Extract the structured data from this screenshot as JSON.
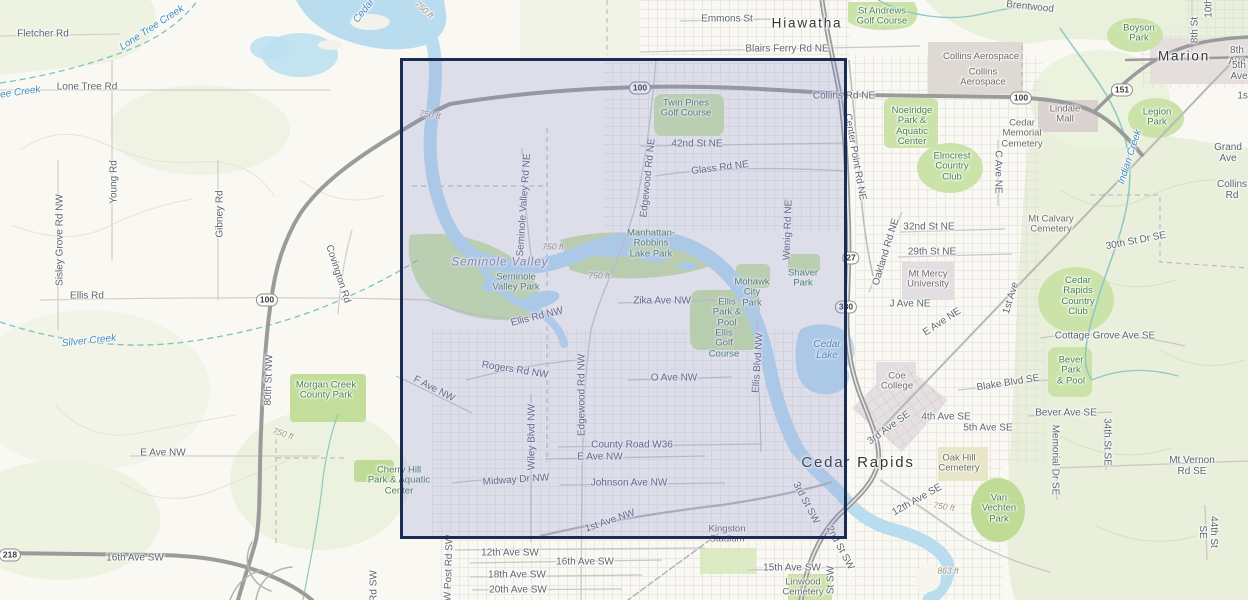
{
  "colors": {
    "selection_border": "#1a2c52",
    "selection_fill": "rgba(126,133,204,0.22)",
    "water": "#b9dcef",
    "water_label": "#3f8cbf",
    "park_fill": "#cbe3a9",
    "park_label": "#47824b",
    "road_label": "#5d666d",
    "poi_label": "#6f6b67",
    "city_label": "#333538",
    "contour_label": "#9c9178",
    "major_road": "#9b9b9b",
    "background": "#f9f8f3"
  },
  "selection": {
    "x": 400,
    "y": 58,
    "width": 447,
    "height": 481
  },
  "map": {
    "labels": [
      {
        "text": "Hiawatha",
        "x": 807,
        "y": 24,
        "type": "city"
      },
      {
        "text": "Marion",
        "x": 1184,
        "y": 57,
        "type": "city"
      },
      {
        "text": "Cedar Rapids",
        "x": 858,
        "y": 463,
        "type": "city",
        "size": 15
      },
      {
        "text": "Fletcher Rd",
        "x": 43,
        "y": 34,
        "type": "road"
      },
      {
        "text": "Lone Tree Rd",
        "x": 87,
        "y": 87,
        "type": "road"
      },
      {
        "text": "Young Rd",
        "x": 114,
        "y": 182,
        "type": "road",
        "rot": -90
      },
      {
        "text": "Sisley Grove Rd NW",
        "x": 60,
        "y": 240,
        "type": "road",
        "rot": -90
      },
      {
        "text": "Gibney Rd",
        "x": 220,
        "y": 214,
        "type": "road",
        "rot": -90
      },
      {
        "text": "Ellis Rd",
        "x": 87,
        "y": 296,
        "type": "road"
      },
      {
        "text": "Covington Rd",
        "x": 338,
        "y": 274,
        "type": "road",
        "rot": 72
      },
      {
        "text": "80th St NW",
        "x": 269,
        "y": 380,
        "type": "road",
        "rot": -88
      },
      {
        "text": "E Ave NW",
        "x": 163,
        "y": 453,
        "type": "road"
      },
      {
        "text": "16th Ave SW",
        "x": 135,
        "y": 558,
        "type": "road"
      },
      {
        "text": "Emmons St",
        "x": 727,
        "y": 19,
        "type": "road"
      },
      {
        "text": "Blairs Ferry Rd NE",
        "x": 787,
        "y": 49,
        "type": "road"
      },
      {
        "text": "Collins Rd NE",
        "x": 844,
        "y": 96,
        "type": "road"
      },
      {
        "text": "42nd St NE",
        "x": 697,
        "y": 144,
        "type": "road"
      },
      {
        "text": "Glass Rd NE",
        "x": 720,
        "y": 168,
        "type": "road",
        "rot": -7
      },
      {
        "text": "Seminole Valley Rd NE",
        "x": 524,
        "y": 205,
        "type": "road",
        "rot": -86
      },
      {
        "text": "Edgewood Rd NE",
        "x": 648,
        "y": 178,
        "type": "road",
        "rot": -84
      },
      {
        "text": "Wenig Rd NE",
        "x": 788,
        "y": 230,
        "type": "road",
        "rot": -88
      },
      {
        "text": "Center Point Rd NE",
        "x": 855,
        "y": 157,
        "type": "road",
        "rot": 80
      },
      {
        "text": "Oakland Rd NE",
        "x": 886,
        "y": 252,
        "type": "road",
        "rot": -73
      },
      {
        "text": "32nd St NE",
        "x": 929,
        "y": 227,
        "type": "road"
      },
      {
        "text": "29th St NE",
        "x": 932,
        "y": 252,
        "type": "road"
      },
      {
        "text": "C Ave NE",
        "x": 998,
        "y": 172,
        "type": "road",
        "rot": 90
      },
      {
        "text": "J Ave NE",
        "x": 910,
        "y": 304,
        "type": "road"
      },
      {
        "text": "E Ave NE",
        "x": 942,
        "y": 322,
        "type": "road",
        "rot": -33
      },
      {
        "text": "1st Ave",
        "x": 1011,
        "y": 298,
        "type": "road",
        "rot": -73
      },
      {
        "text": "Grand Ave",
        "x": 1228,
        "y": 153,
        "type": "road"
      },
      {
        "text": "Collins Rd",
        "x": 1232,
        "y": 190,
        "type": "road"
      },
      {
        "text": "8th Ave",
        "x": 1237,
        "y": 56,
        "type": "road"
      },
      {
        "text": "5th Ave",
        "x": 1239,
        "y": 71,
        "type": "road"
      },
      {
        "text": "1st",
        "x": 1244,
        "y": 96,
        "type": "road"
      },
      {
        "text": "8th St",
        "x": 1195,
        "y": 30,
        "type": "road",
        "rot": -90
      },
      {
        "text": "10th",
        "x": 1209,
        "y": 8,
        "type": "road",
        "rot": -90
      },
      {
        "text": "Brentwood",
        "x": 1030,
        "y": 7,
        "type": "road",
        "rot": 6
      },
      {
        "text": "30th St Dr SE",
        "x": 1136,
        "y": 241,
        "type": "road",
        "rot": -11
      },
      {
        "text": "Cottage Grove Ave SE",
        "x": 1105,
        "y": 336,
        "type": "road"
      },
      {
        "text": "Blake Blvd SE",
        "x": 1008,
        "y": 383,
        "type": "road",
        "rot": -9
      },
      {
        "text": "Bever Ave SE",
        "x": 1066,
        "y": 413,
        "type": "road"
      },
      {
        "text": "4th Ave SE",
        "x": 946,
        "y": 417,
        "type": "road"
      },
      {
        "text": "5th Ave SE",
        "x": 988,
        "y": 428,
        "type": "road"
      },
      {
        "text": "3rd Ave SE",
        "x": 889,
        "y": 428,
        "type": "road",
        "rot": -36
      },
      {
        "text": "12th Ave SE",
        "x": 917,
        "y": 500,
        "type": "road",
        "rot": -29
      },
      {
        "text": "Mt Vernon Rd SE",
        "x": 1192,
        "y": 466,
        "type": "road"
      },
      {
        "text": "Memorial Dr SE",
        "x": 1055,
        "y": 460,
        "type": "road",
        "rot": 90
      },
      {
        "text": "34th St SE",
        "x": 1107,
        "y": 442,
        "type": "road",
        "rot": 90
      },
      {
        "text": "44th St SE",
        "x": 1208,
        "y": 532,
        "type": "road",
        "rot": 90
      },
      {
        "text": "15th Ave SW",
        "x": 792,
        "y": 568,
        "type": "road"
      },
      {
        "text": "12th Ave SW",
        "x": 510,
        "y": 553,
        "type": "road"
      },
      {
        "text": "16th Ave SW",
        "x": 585,
        "y": 562,
        "type": "road"
      },
      {
        "text": "18th Ave SW",
        "x": 517,
        "y": 575,
        "type": "road"
      },
      {
        "text": "20th Ave SW",
        "x": 518,
        "y": 590,
        "type": "road"
      },
      {
        "text": "W Post Rd SW",
        "x": 449,
        "y": 568,
        "type": "road",
        "rot": -88
      },
      {
        "text": "3rd St SW",
        "x": 806,
        "y": 503,
        "type": "road",
        "rot": 62
      },
      {
        "text": "2nd St SW",
        "x": 840,
        "y": 548,
        "type": "road",
        "rot": 62
      },
      {
        "text": "St SW",
        "x": 831,
        "y": 580,
        "type": "road",
        "rot": -90
      },
      {
        "text": "Rd SW",
        "x": 374,
        "y": 586,
        "type": "road",
        "rot": -90
      },
      {
        "text": "Ellis Rd NW",
        "x": 537,
        "y": 317,
        "type": "road",
        "rot": -14
      },
      {
        "text": "Rogers Rd NW",
        "x": 515,
        "y": 370,
        "type": "road",
        "rot": 9
      },
      {
        "text": "F Ave NW",
        "x": 434,
        "y": 389,
        "type": "road",
        "rot": 27
      },
      {
        "text": "Wiley Blvd NW",
        "x": 532,
        "y": 437,
        "type": "road",
        "rot": -90
      },
      {
        "text": "Edgewood Rd NW",
        "x": 582,
        "y": 395,
        "type": "road",
        "rot": -90
      },
      {
        "text": "Zika Ave NW",
        "x": 662,
        "y": 301,
        "type": "road"
      },
      {
        "text": "O Ave NW",
        "x": 674,
        "y": 378,
        "type": "road"
      },
      {
        "text": "County Road W36",
        "x": 632,
        "y": 445,
        "type": "road"
      },
      {
        "text": "E Ave NW",
        "x": 600,
        "y": 457,
        "type": "road"
      },
      {
        "text": "Midway Dr NW",
        "x": 516,
        "y": 480,
        "type": "road",
        "rot": -4
      },
      {
        "text": "Johnson Ave NW",
        "x": 629,
        "y": 483,
        "type": "road"
      },
      {
        "text": "1st Ave NW",
        "x": 610,
        "y": 521,
        "type": "road",
        "rot": -19
      },
      {
        "text": "Ellis Blvd NW",
        "x": 758,
        "y": 363,
        "type": "road",
        "rot": -86
      },
      {
        "text": "St Andrews\nGolf Course",
        "x": 882,
        "y": 17,
        "type": "park"
      },
      {
        "text": "Boyson\nPark",
        "x": 1139,
        "y": 34,
        "type": "park"
      },
      {
        "text": "Noelridge\nPark &\nAquatic\nCenter",
        "x": 912,
        "y": 127,
        "type": "park"
      },
      {
        "text": "Legion\nPark",
        "x": 1157,
        "y": 118,
        "type": "park"
      },
      {
        "text": "Elmcrest\nCountry\nClub",
        "x": 952,
        "y": 167,
        "type": "park"
      },
      {
        "text": "Twin Pines\nGolf Course",
        "x": 686,
        "y": 109,
        "type": "park"
      },
      {
        "text": "Seminole\nValley Park",
        "x": 516,
        "y": 283,
        "type": "park"
      },
      {
        "text": "Manhattan-\nRobbins\nLake Park",
        "x": 651,
        "y": 244,
        "type": "park"
      },
      {
        "text": "Mohawk\nCity\nPark",
        "x": 752,
        "y": 293,
        "type": "park"
      },
      {
        "text": "Shaver\nPark",
        "x": 803,
        "y": 279,
        "type": "park"
      },
      {
        "text": "Ellis\nPark &\nPool",
        "x": 727,
        "y": 313,
        "type": "park"
      },
      {
        "text": "Ellis\nGolf\nCourse",
        "x": 724,
        "y": 344,
        "type": "park"
      },
      {
        "text": "Morgan Creek\nCounty Park",
        "x": 326,
        "y": 391,
        "type": "park"
      },
      {
        "text": "Cherry Hill\nPark & Aquatic\nCenter",
        "x": 399,
        "y": 481,
        "type": "park"
      },
      {
        "text": "Bever\nPark\n& Pool",
        "x": 1071,
        "y": 371,
        "type": "park"
      },
      {
        "text": "Van\nVechten\nPark",
        "x": 999,
        "y": 509,
        "type": "park"
      },
      {
        "text": "Cedar\nRapids\nCountry\nClub",
        "x": 1078,
        "y": 297,
        "type": "park"
      },
      {
        "text": "Collins Aerospace",
        "x": 981,
        "y": 57,
        "type": "poi"
      },
      {
        "text": "Collins\nAerospace",
        "x": 983,
        "y": 78,
        "type": "poi"
      },
      {
        "text": "Lindale\nMall",
        "x": 1065,
        "y": 115,
        "type": "poi"
      },
      {
        "text": "Cedar\nMemorial\nCemetery",
        "x": 1022,
        "y": 134,
        "type": "poi"
      },
      {
        "text": "Mt Calvary\nCemetery",
        "x": 1051,
        "y": 225,
        "type": "poi"
      },
      {
        "text": "Mt Mercy\nUniversity",
        "x": 928,
        "y": 280,
        "type": "poi"
      },
      {
        "text": "Coe\nCollege",
        "x": 897,
        "y": 382,
        "type": "poi"
      },
      {
        "text": "Oak Hill\nCemetery",
        "x": 959,
        "y": 464,
        "type": "poi"
      },
      {
        "text": "Kingston\nStadium",
        "x": 727,
        "y": 535,
        "type": "poi"
      },
      {
        "text": "Linwood\nCemetery",
        "x": 803,
        "y": 588,
        "type": "poi"
      },
      {
        "text": "Lone Tree Creek",
        "x": 152,
        "y": 28,
        "type": "water",
        "rot": -33
      },
      {
        "text": "Tree Creek",
        "x": 16,
        "y": 93,
        "type": "water",
        "rot": -8
      },
      {
        "text": "Silver Creek",
        "x": 89,
        "y": 341,
        "type": "water",
        "rot": -6
      },
      {
        "text": "Cedar",
        "x": 364,
        "y": 11,
        "type": "water",
        "rot": -52
      },
      {
        "text": "Cedar\nLake",
        "x": 827,
        "y": 350,
        "type": "water"
      },
      {
        "text": "Indian Creek",
        "x": 1130,
        "y": 157,
        "type": "water",
        "rot": -72
      },
      {
        "text": "Seminole Valley",
        "x": 500,
        "y": 263,
        "type": "area"
      },
      {
        "text": "750 ft",
        "x": 424,
        "y": 10,
        "type": "contour",
        "rot": 42
      },
      {
        "text": "750 ft",
        "x": 430,
        "y": 115,
        "type": "contour",
        "rot": 8
      },
      {
        "text": "750 ft",
        "x": 553,
        "y": 247,
        "type": "contour"
      },
      {
        "text": "750 ft",
        "x": 599,
        "y": 276,
        "type": "contour"
      },
      {
        "text": "750 ft",
        "x": 283,
        "y": 434,
        "type": "contour",
        "rot": 18
      },
      {
        "text": "750 ft",
        "x": 944,
        "y": 507,
        "type": "contour",
        "rot": 8
      },
      {
        "text": "863 ft",
        "x": 948,
        "y": 571,
        "type": "contour"
      },
      {
        "text": "100",
        "x": 640,
        "y": 88,
        "type": "shield"
      },
      {
        "text": "100",
        "x": 1021,
        "y": 98,
        "type": "shield"
      },
      {
        "text": "100",
        "x": 267,
        "y": 300,
        "type": "shield"
      },
      {
        "text": "151",
        "x": 1122,
        "y": 90,
        "type": "shield"
      },
      {
        "text": "27",
        "x": 851,
        "y": 258,
        "type": "shield"
      },
      {
        "text": "380",
        "x": 846,
        "y": 307,
        "type": "shield"
      },
      {
        "text": "218",
        "x": 10,
        "y": 555,
        "type": "shield"
      }
    ]
  }
}
